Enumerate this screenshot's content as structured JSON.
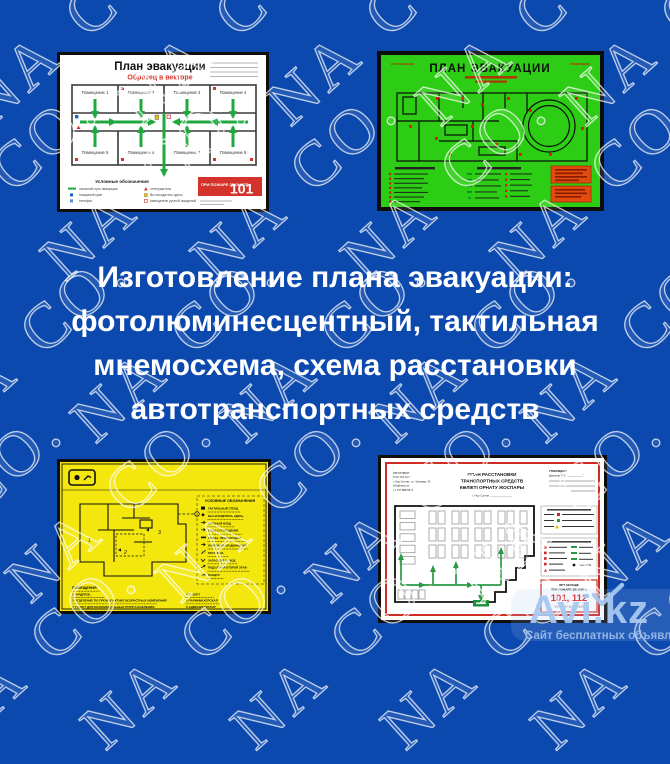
{
  "page": {
    "background_color": "#0c49ae",
    "watermark_text": "NA CO."
  },
  "headline": {
    "line1": "Изготовление плана эвакуации:",
    "line2": "фотолюминесцентный, тактильная",
    "line3": "мнемосхема, схема расстановки",
    "line4": "автотранспортных средств"
  },
  "plan_vector": {
    "title": "План эвакуации",
    "subtitle": "Образец в векторе",
    "rooms": [
      "Помещение 1",
      "Помещение 2",
      "Помещение 3",
      "Помещение 4",
      "Помещение 5",
      "Помещение 6",
      "Помещение 7",
      "Помещение 8"
    ],
    "legend_title": "Условные обозначения",
    "legend_left": [
      "основной путь эвакуации",
      "пожарный кран",
      "телефон"
    ],
    "legend_right": [
      "огнетушитель",
      "Вы находитесь здесь",
      "извещатель ручной пожарный"
    ],
    "call_text": "ПРИ ПОЖАРЕ ЗВОНИТЕ",
    "call_number": "101",
    "accent_color": "#d4332b",
    "arrow_color": "#1fa83e"
  },
  "plan_photolum": {
    "title": "ПЛАН ЭВАКУАЦИИ",
    "corner_left": "СОГЛАСОВАНО",
    "corner_right": "УТВЕРЖДАЮ",
    "background_color": "#2ccd14"
  },
  "plan_tactile": {
    "legend_title": "УСЛОВНЫЕ ОБОЗНАЧЕНИЯ",
    "legend_items": [
      "ТАКТИЛЬНЫЙ СТЕНД",
      "ВЫ НАХОДИТЕСЬ ЗДЕСЬ",
      "ГЛАВНЫЙ ВХОД",
      "ВХОД В ПОМЕЩЕНИЕ",
      "СТЕНЫ, ПЕРЕГОРОДКИ",
      "НАПРАВЛЕНИЯ ДВИЖЕНИЯ",
      "ЛЕСТНИЦА",
      "ЗАПАСНОЙ ВЫХОД",
      "ПОДЪЕМ НА ВТОРОЙ ЭТАЖ",
      "ПАНДУС"
    ],
    "rooms_title": "ПОМЕЩЕНИЯ",
    "rooms_left": [
      "1  ГАРДЕРОБ",
      "2  ОТДЕЛЕНИЕ ПО ПРОФИЛАКТИКЕ ВОЗРАСТНЫХ ИЗМЕНЕНИЙ",
      "3  ТУАЛЕТ ДЛЯ МАЛОМОБИЛЬНЫХ ГРУПП НАСЕЛЕНИЯ"
    ],
    "rooms_right": [
      "4  ТУАЛЕТ",
      "5  ПАРИКМАХЕРСКАЯ",
      "6  АДМИНИСТРАТОР"
    ],
    "background_color": "#f3e70d"
  },
  "plan_parking": {
    "maker_lines": [
      "ИЗГОТОВИЛ:",
      "ТОО \"NA CO.\"",
      "г. Нур-Султан, ул. Кунаева, 33",
      "info@naco.kz",
      "+7 707 888 9600"
    ],
    "title_line1": "ПЛАН РАССТАНОВКИ",
    "title_line2": "ТРАНСПОРТНЫХ СРЕДСТВ",
    "title_line3": "КӨЛІКТІ ОРНАТУ ЖОСПАРЫ",
    "city_line": "г. Нур-Султан, ______________",
    "approve_title": "УТВЕРЖДАЮ",
    "approve_sub": "Директор ТОО \"___________\"",
    "call_line1": "ӨРТ КЕЗІНДЕ",
    "call_line2": "ПРИ ПОЖАРЕ ЗВОНИТЬ",
    "call_numbers": "101, 112",
    "call_line3": "ҚОҢЫРАУ ШАЛЫҢЫЗ"
  },
  "logo": {
    "name": "Avi.kz",
    "tagline": "Сайт бесплатных объявлений"
  }
}
